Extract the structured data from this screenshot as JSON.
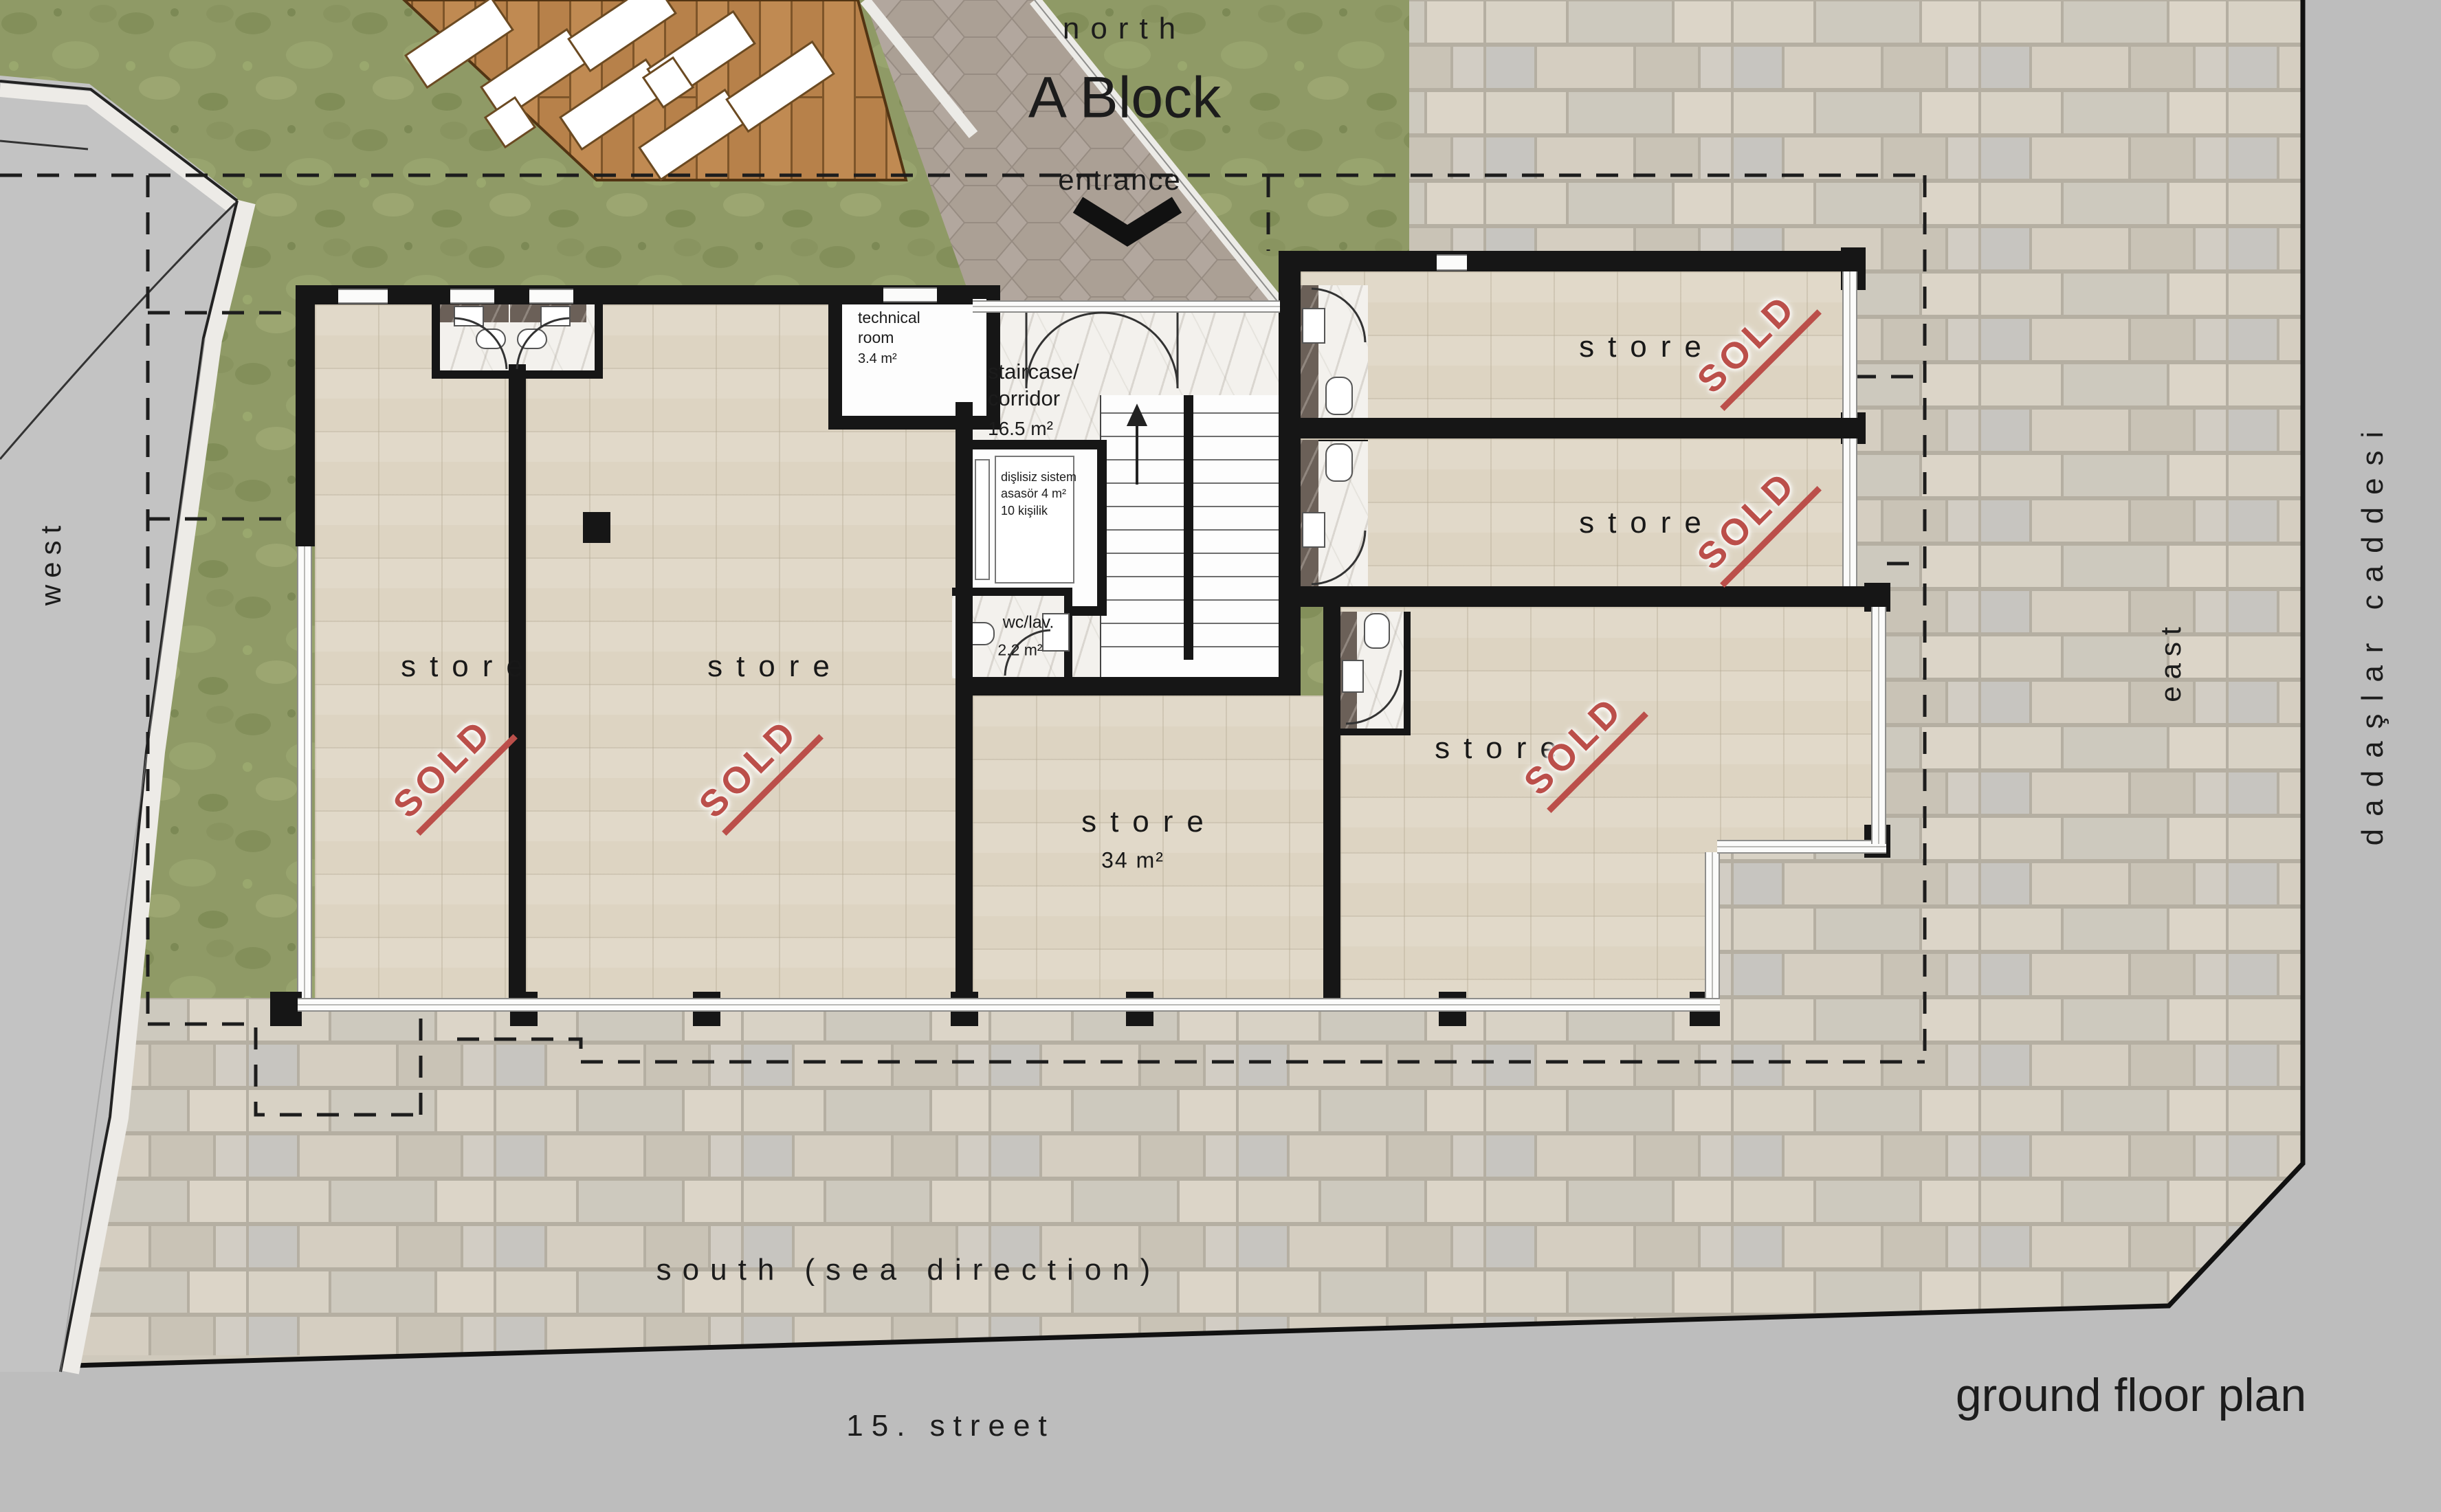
{
  "compass": {
    "north": "north"
  },
  "header": {
    "block_title": "A Block",
    "entrance_label": "entrance"
  },
  "streets": {
    "west": "west",
    "east": "east",
    "south": "south (sea direction)",
    "street_15": "15. street",
    "avenue": "dadaşlar caddesi"
  },
  "plan": {
    "title": "ground floor plan"
  },
  "rooms": {
    "store_west_1": {
      "label": "store",
      "status": "SOLD"
    },
    "store_west_2": {
      "label": "store",
      "status": "SOLD"
    },
    "store_middle": {
      "label": "store",
      "area": "34 m²"
    },
    "store_east_top": {
      "label": "store",
      "status": "SOLD"
    },
    "store_east_mid": {
      "label": "store",
      "status": "SOLD"
    },
    "store_east_big": {
      "label": "store",
      "status": "SOLD"
    },
    "technical_room": {
      "name_line1": "technical",
      "name_line2": "room",
      "area": "3.4 m²"
    },
    "staircase": {
      "name_line1": "staircase/",
      "name_line2": "corridor",
      "area": "16.5 m²"
    },
    "elevator": {
      "line1": "dişlisiz sistem",
      "line2": "asasör 4 m²",
      "line3": "10 kişilik"
    },
    "wc_lav": {
      "label": "wc/lav.",
      "area": "2.2 m²"
    }
  }
}
